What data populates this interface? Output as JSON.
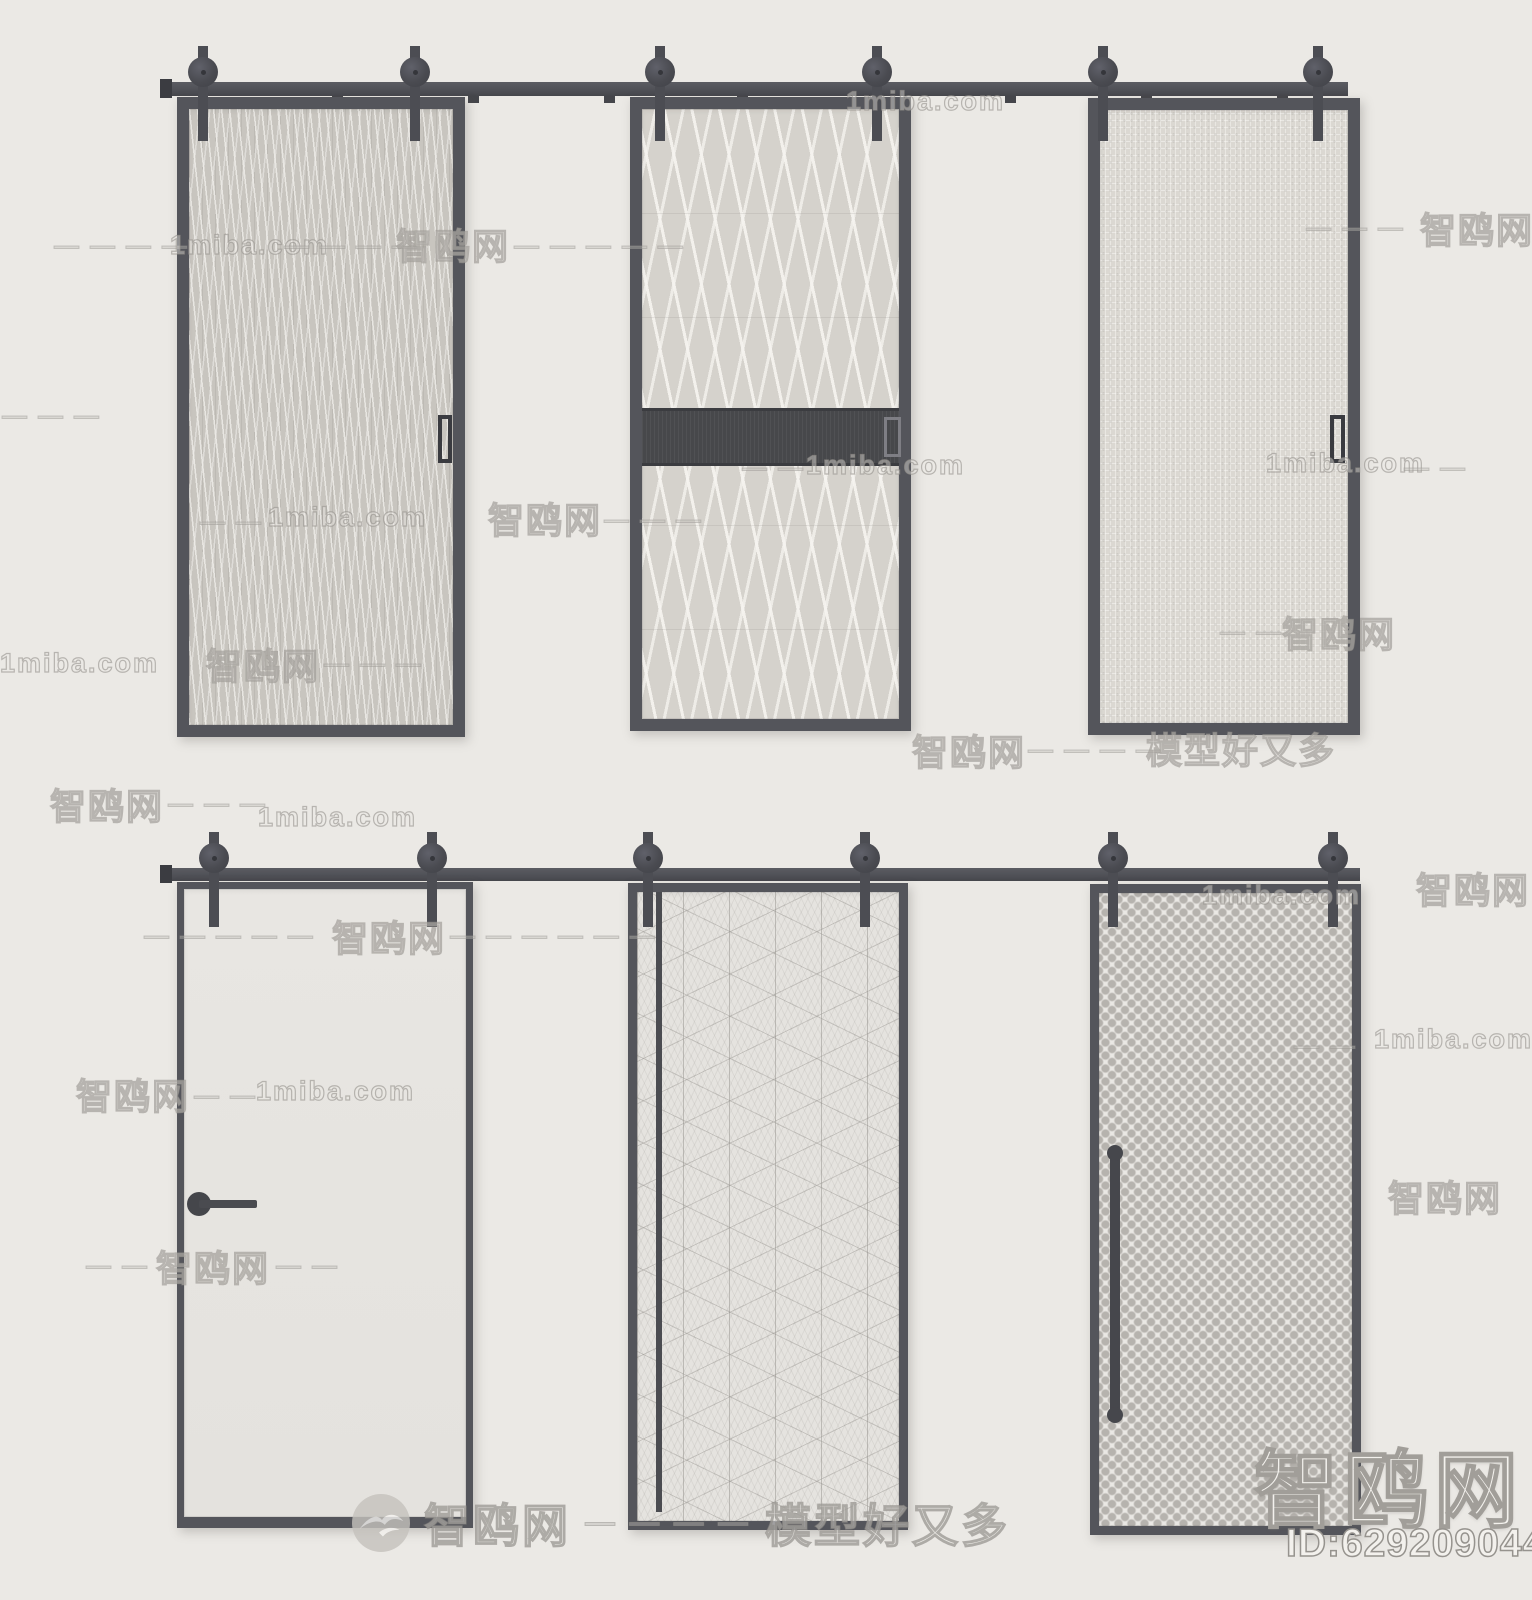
{
  "meta": {
    "width": 1532,
    "height": 1600,
    "background": "#ebe9e5"
  },
  "branding": {
    "site_name": "智鸥网",
    "site_domain": "1miba.com",
    "tagline": "模型好又多",
    "model_id": "ID:629209044",
    "footer_dashes": "— — — —"
  },
  "colors": {
    "hardware": "#54555b",
    "hardware_dark": "#3b3c41",
    "band": "#47484b",
    "background": "#ebe9e5"
  },
  "rows": [
    {
      "name": "top-row",
      "rail": {
        "x": 160,
        "y": 82,
        "w": 1188,
        "h": 14
      },
      "endcap": {
        "x": 160,
        "y": 79,
        "w": 12,
        "h": 19
      },
      "brackets": [
        332,
        468,
        604,
        737,
        1005,
        1141,
        1277
      ],
      "bracket_y": 94,
      "rollers": {
        "cy": 72,
        "r": 15,
        "strap_bottom": 141,
        "cx": [
          203,
          415,
          660,
          877,
          1103,
          1318
        ]
      },
      "doors": [
        {
          "id": "door-1",
          "desc": "dark frame sliding door, vertical streaked glass, flush pull right",
          "x": 177,
          "y": 97,
          "w": 288,
          "h": 640,
          "frame": 12,
          "pattern": "streaks",
          "handles": [
            {
              "type": "flush",
              "x": 438,
              "y": 415,
              "w": 14,
              "h": 48
            }
          ]
        },
        {
          "id": "door-2",
          "desc": "dark frame sliding door, chevron glass, dark mid crossbar with recessed pull",
          "x": 630,
          "y": 97,
          "w": 281,
          "h": 634,
          "frame": 12,
          "pattern": "chevrons",
          "band": {
            "y": 408,
            "h": 58
          },
          "handles": [
            {
              "type": "band-pull",
              "x": 884,
              "y": 417,
              "w": 17,
              "h": 40
            }
          ]
        },
        {
          "id": "door-3",
          "desc": "dark frame sliding door, fine weave glass, flush pull right",
          "x": 1088,
          "y": 98,
          "w": 272,
          "h": 637,
          "frame": 12,
          "pattern": "weave",
          "handles": [
            {
              "type": "flush",
              "x": 1330,
              "y": 415,
              "w": 15,
              "h": 48
            }
          ]
        }
      ]
    },
    {
      "name": "bottom-row",
      "rail": {
        "x": 160,
        "y": 868,
        "w": 1200,
        "h": 13
      },
      "endcap": {
        "x": 160,
        "y": 865,
        "w": 12,
        "h": 18
      },
      "brackets": [],
      "bracket_y": 880,
      "rollers": {
        "cy": 858,
        "r": 15,
        "strap_bottom": 927,
        "cx": [
          214,
          432,
          648,
          865,
          1113,
          1333
        ]
      },
      "doors": [
        {
          "id": "door-4",
          "desc": "thin frame plain white sliding door with round-rose lever handle",
          "x": 177,
          "y": 882,
          "w": 296,
          "h": 646,
          "frame": 7,
          "frame_bottom": 11,
          "pattern": "plain",
          "handles": [
            {
              "type": "lever",
              "cx": 199,
              "cy": 1204,
              "r": 12,
              "bar_w": 58,
              "bar_h": 8
            }
          ]
        },
        {
          "id": "door-5",
          "desc": "dark frame sliding door, isometric cube lattice glass, full-height rod pull",
          "x": 628,
          "y": 883,
          "w": 280,
          "h": 647,
          "frame": 9,
          "pattern": "cubes",
          "handles": [
            {
              "type": "rod",
              "x": 656,
              "y": 892,
              "w": 6,
              "h": 620
            }
          ]
        },
        {
          "id": "door-6",
          "desc": "dark frame sliding door, dotted mesh glass, vertical bar pull",
          "x": 1090,
          "y": 884,
          "w": 271,
          "h": 651,
          "frame": 9,
          "pattern": "dots",
          "handles": [
            {
              "type": "bar",
              "x": 1110,
              "y": 1150,
              "w": 10,
              "h": 268
            }
          ]
        }
      ]
    }
  ],
  "watermarks": [
    {
      "text": "1miba.com",
      "x": 846,
      "y": 86,
      "fs": 27
    },
    {
      "text": "— — — —",
      "x": 54,
      "y": 232,
      "fs": 25,
      "kind": "dash"
    },
    {
      "text": "1miba.com",
      "x": 170,
      "y": 230,
      "fs": 27
    },
    {
      "text": "— — — —",
      "x": 284,
      "y": 232,
      "fs": 25,
      "kind": "dash"
    },
    {
      "text": "智鸥网",
      "x": 396,
      "y": 218,
      "fs": 36
    },
    {
      "text": "— — — — —",
      "x": 514,
      "y": 232,
      "fs": 25,
      "kind": "dash"
    },
    {
      "text": "— — —",
      "x": 1306,
      "y": 214,
      "fs": 25,
      "kind": "dash"
    },
    {
      "text": "智鸥网",
      "x": 1420,
      "y": 202,
      "fs": 36
    },
    {
      "text": "— — —",
      "x": 2,
      "y": 402,
      "fs": 25,
      "kind": "dash"
    },
    {
      "text": "— —",
      "x": 742,
      "y": 454,
      "fs": 25,
      "kind": "dash"
    },
    {
      "text": "1miba.com",
      "x": 806,
      "y": 450,
      "fs": 27
    },
    {
      "text": "1miba.com",
      "x": 1266,
      "y": 448,
      "fs": 27
    },
    {
      "text": "— —",
      "x": 1404,
      "y": 454,
      "fs": 25,
      "kind": "dash"
    },
    {
      "text": "— —",
      "x": 200,
      "y": 508,
      "fs": 25,
      "kind": "dash"
    },
    {
      "text": "1miba.com",
      "x": 268,
      "y": 502,
      "fs": 27
    },
    {
      "text": "智鸥网",
      "x": 488,
      "y": 492,
      "fs": 36
    },
    {
      "text": "— — —",
      "x": 604,
      "y": 506,
      "fs": 25,
      "kind": "dash"
    },
    {
      "text": "1miba.com",
      "x": 0,
      "y": 648,
      "fs": 27
    },
    {
      "text": "智鸥网",
      "x": 206,
      "y": 638,
      "fs": 36
    },
    {
      "text": "— — —",
      "x": 324,
      "y": 650,
      "fs": 25,
      "kind": "dash"
    },
    {
      "text": "— —",
      "x": 1220,
      "y": 618,
      "fs": 25,
      "kind": "dash"
    },
    {
      "text": "智鸥网",
      "x": 1282,
      "y": 606,
      "fs": 36
    },
    {
      "text": "智鸥网",
      "x": 912,
      "y": 724,
      "fs": 36
    },
    {
      "text": "— — — —",
      "x": 1028,
      "y": 736,
      "fs": 25,
      "kind": "dash"
    },
    {
      "text": "模型好又多",
      "x": 1146,
      "y": 722,
      "fs": 36
    },
    {
      "text": "智鸥网",
      "x": 50,
      "y": 778,
      "fs": 36
    },
    {
      "text": "— — —",
      "x": 168,
      "y": 790,
      "fs": 25,
      "kind": "dash"
    },
    {
      "text": "1miba.com",
      "x": 258,
      "y": 802,
      "fs": 27
    },
    {
      "text": "— — — — —",
      "x": 144,
      "y": 922,
      "fs": 25,
      "kind": "dash"
    },
    {
      "text": "智鸥网",
      "x": 332,
      "y": 910,
      "fs": 36
    },
    {
      "text": "— — — — — —",
      "x": 450,
      "y": 922,
      "fs": 25,
      "kind": "dash"
    },
    {
      "text": "1miba.com",
      "x": 1202,
      "y": 880,
      "fs": 27
    },
    {
      "text": "智鸥网",
      "x": 1416,
      "y": 862,
      "fs": 36
    },
    {
      "text": "— —",
      "x": 1294,
      "y": 1032,
      "fs": 25,
      "kind": "dash"
    },
    {
      "text": "1miba.com",
      "x": 1374,
      "y": 1024,
      "fs": 27
    },
    {
      "text": "智鸥网",
      "x": 76,
      "y": 1068,
      "fs": 36
    },
    {
      "text": "— —",
      "x": 194,
      "y": 1082,
      "fs": 25,
      "kind": "dash"
    },
    {
      "text": "1miba.com",
      "x": 256,
      "y": 1076,
      "fs": 27
    },
    {
      "text": "智鸥网",
      "x": 1388,
      "y": 1170,
      "fs": 36
    },
    {
      "text": "— —",
      "x": 86,
      "y": 1252,
      "fs": 25,
      "kind": "dash"
    },
    {
      "text": "智鸥网",
      "x": 156,
      "y": 1240,
      "fs": 36
    },
    {
      "text": "— —",
      "x": 276,
      "y": 1252,
      "fs": 25,
      "kind": "dash"
    }
  ]
}
